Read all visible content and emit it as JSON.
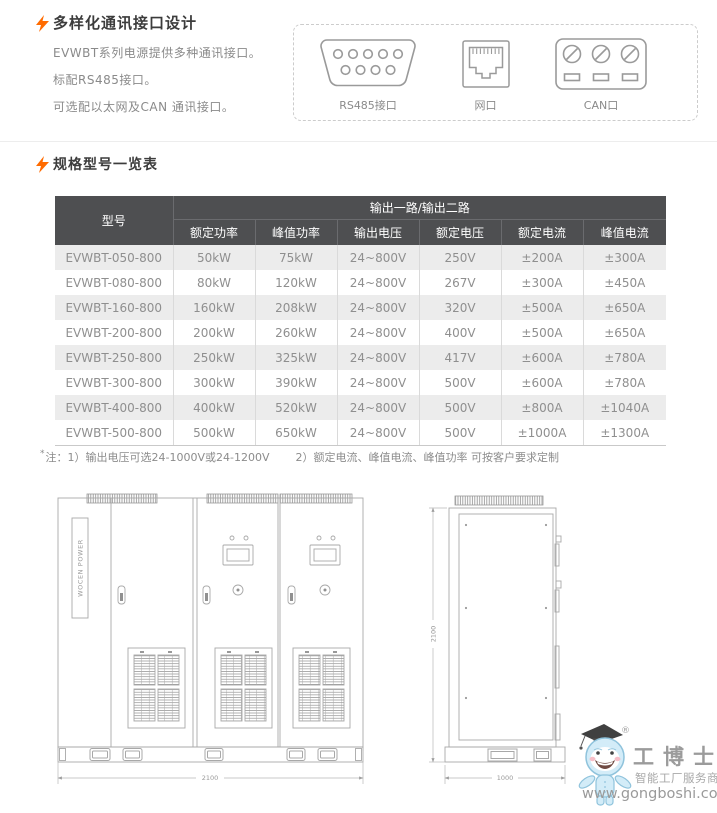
{
  "colors": {
    "accent_orange": "#ff6b00",
    "table_header_bg": "#4e4f51",
    "table_row_alt": "#ececec",
    "title_text": "#3c3c3c",
    "body_text": "#8a8a8a",
    "drawing_line": "#a8a8a8"
  },
  "comm_section": {
    "title": "多样化通讯接口设计",
    "lines": [
      "EVWBT系列电源提供多种通讯接口。",
      "标配RS485接口。",
      "可选配以太网及CAN 通讯接口。"
    ],
    "ports": {
      "rs485": "RS485接口",
      "ethernet": "网口",
      "can": "CAN口"
    }
  },
  "spec_section": {
    "title": "规格型号一览表",
    "table": {
      "model_header": "型号",
      "group_header": "输出一路/输出二路",
      "sub_headers": [
        "额定功率",
        "峰值功率",
        "输出电压",
        "额定电压",
        "额定电流",
        "峰值电流"
      ],
      "rows": [
        [
          "EVWBT-050-800",
          "50kW",
          "75kW",
          "24~800V",
          "250V",
          "±200A",
          "±300A"
        ],
        [
          "EVWBT-080-800",
          "80kW",
          "120kW",
          "24~800V",
          "267V",
          "±300A",
          "±450A"
        ],
        [
          "EVWBT-160-800",
          "160kW",
          "208kW",
          "24~800V",
          "320V",
          "±500A",
          "±650A"
        ],
        [
          "EVWBT-200-800",
          "200kW",
          "260kW",
          "24~800V",
          "400V",
          "±500A",
          "±650A"
        ],
        [
          "EVWBT-250-800",
          "250kW",
          "325kW",
          "24~800V",
          "417V",
          "±600A",
          "±780A"
        ],
        [
          "EVWBT-300-800",
          "300kW",
          "390kW",
          "24~800V",
          "500V",
          "±600A",
          "±780A"
        ],
        [
          "EVWBT-400-800",
          "400kW",
          "520kW",
          "24~800V",
          "500V",
          "±800A",
          "±1040A"
        ],
        [
          "EVWBT-500-800",
          "500kW",
          "650kW",
          "24~800V",
          "500V",
          "±1000A",
          "±1300A"
        ]
      ]
    },
    "note_star": "*",
    "note1": "注：1）输出电压可选24-1000V或24-1200V",
    "note2": "2）额定电流、峰值电流、峰值功率 可按客户要求定制"
  },
  "drawings": {
    "cabinet_brand": "WOCEN POWER",
    "front_width_mm": "2100",
    "height_mm": "2100",
    "depth_mm": "1000"
  },
  "watermark": {
    "registered": "®",
    "brand": "工博士",
    "tagline": "智能工厂服务商",
    "url": "www.gongboshi.com"
  }
}
